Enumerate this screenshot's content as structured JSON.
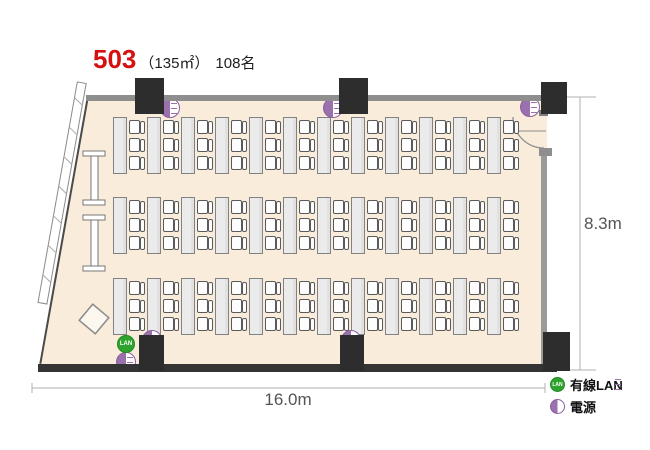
{
  "title": {
    "room_number": "503",
    "area": "（135㎡）",
    "capacity": "108名"
  },
  "dimensions": {
    "width": "16.0m",
    "height": "8.3m"
  },
  "legend": {
    "lan_badge": "LAN",
    "lan_label": "有線LAN",
    "power_label": "電源"
  },
  "floor_plan": {
    "type": "room-layout",
    "room_number": "503",
    "area_sqm": 135,
    "capacity_seats": 108,
    "room_width_m": 16.0,
    "room_height_m": 8.3,
    "seating": {
      "bands": 3,
      "tables_per_band": 12,
      "chairs_per_table": 3,
      "total_seats": 108,
      "band_tops": [
        117,
        197,
        278
      ],
      "col_start": 113,
      "col_pitch": 34,
      "table_w": 14,
      "table_h": 57,
      "chair_offsets": [
        3,
        21,
        39
      ]
    },
    "pillars": [
      {
        "x": 135,
        "y": 78,
        "w": 29,
        "h": 36
      },
      {
        "x": 339,
        "y": 78,
        "w": 29,
        "h": 36
      },
      {
        "x": 541,
        "y": 82,
        "w": 26,
        "h": 32
      },
      {
        "x": 139,
        "y": 335,
        "w": 25,
        "h": 36
      },
      {
        "x": 340,
        "y": 335,
        "w": 24,
        "h": 36
      },
      {
        "x": 543,
        "y": 332,
        "w": 27,
        "h": 39
      }
    ],
    "power_outlets": [
      {
        "cx": 170,
        "cy": 108
      },
      {
        "cx": 333,
        "cy": 108
      },
      {
        "cx": 530,
        "cy": 107
      },
      {
        "cx": 152,
        "cy": 340
      },
      {
        "cx": 351,
        "cy": 340
      },
      {
        "cx": 126,
        "cy": 362
      }
    ],
    "lan_ports": [
      {
        "cx": 126,
        "cy": 344
      }
    ]
  },
  "colors": {
    "accent_red": "#d60f0f",
    "floor": "#f9ecda",
    "wall_gray": "#8e8e8e",
    "wall_dark": "#343434",
    "pillar": "#2d2d2d",
    "lan_green": "#2fa32f",
    "power_purple": "#9a70ad"
  }
}
